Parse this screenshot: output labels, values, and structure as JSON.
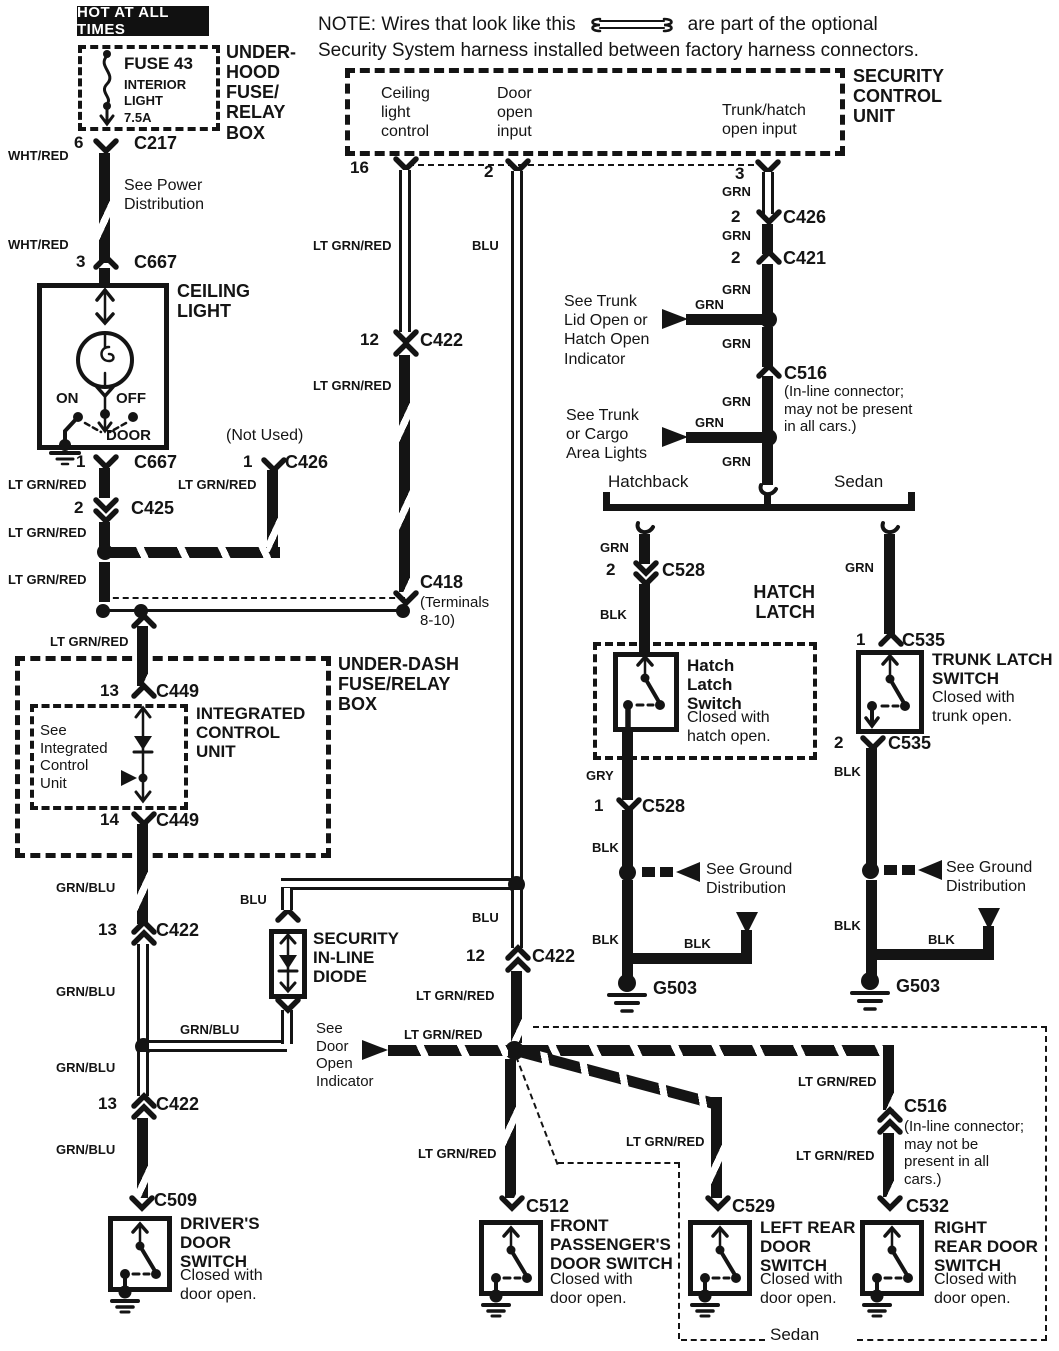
{
  "note": {
    "line1_pre": "NOTE: Wires that look like this",
    "line1_post": "are part of the optional",
    "line2": "Security System harness installed between factory harness connectors."
  },
  "wirelabels": {
    "wht_red": "WHT/RED",
    "lt_grn_red": "LT GRN/RED",
    "blu": "BLU",
    "grn": "GRN",
    "blk": "BLK",
    "gry": "GRY",
    "grn_blu": "GRN/BLU"
  },
  "underhood": {
    "hot": "HOT AT ALL TIMES",
    "fuse": "FUSE 43",
    "fuse_sub": "INTERIOR\nLIGHT\n7.5A",
    "box": "UNDER-\nHOOD\nFUSE/\nRELAY\nBOX",
    "pin6": "6",
    "c217": "C217",
    "see_power": "See Power\nDistribution",
    "pin3": "3",
    "c667": "C667"
  },
  "ceiling": {
    "title": "CEILING\nLIGHT",
    "on": "ON",
    "off": "OFF",
    "door": "DOOR",
    "pin1": "1",
    "c667": "C667",
    "pin2": "2",
    "c425": "C425",
    "not_used": "(Not Used)",
    "pin1_c426": "1",
    "c426": "C426"
  },
  "scu": {
    "title": "SECURITY\nCONTROL\nUNIT",
    "ceiling_ctl": "Ceiling\nlight\ncontrol",
    "door_input": "Door\nopen\ninput",
    "trunk_input": "Trunk/hatch\nopen input",
    "pin16": "16",
    "pin2": "2",
    "pin3": "3"
  },
  "run405": {
    "pin12": "12",
    "c422": "C422",
    "c418": "C418",
    "c418_sub": "(Terminals\n8-10)"
  },
  "trunkcol": {
    "pin2_c426": "2",
    "c426": "C426",
    "pin2_c421": "2",
    "c421": "C421",
    "see_trunk_lid": "See Trunk\nLid Open or\nHatch Open\nIndicator",
    "c516": "C516",
    "c516_sub": "(In-line connector;\nmay not be present\nin all cars.)",
    "see_cargo": "See Trunk\nor Cargo\nArea Lights",
    "hatchback": "Hatchback",
    "sedan": "Sedan"
  },
  "hatch": {
    "pin2": "2",
    "c528": "C528",
    "title": "HATCH\nLATCH",
    "name": "Hatch\nLatch\nSwitch",
    "desc": "Closed with\nhatch open.",
    "pin1": "1",
    "c528_lower": "C528",
    "see_ground": "See Ground\nDistribution",
    "g503": "G503"
  },
  "sedantrunk": {
    "pin1": "1",
    "c535": "C535",
    "name": "TRUNK LATCH\nSWITCH",
    "desc": "Closed with\ntrunk open.",
    "pin2": "2",
    "c535_lower": "C535",
    "see_ground": "See Ground\nDistribution",
    "g503": "G503"
  },
  "underdash": {
    "title": "UNDER-DASH\nFUSE/RELAY\nBOX",
    "pin13": "13",
    "c449": "C449",
    "icu_title": "INTEGRATED\nCONTROL\nUNIT",
    "icu_see": "See\nIntegrated\nControl\nUnit",
    "pin14": "14",
    "c449_lower": "C449"
  },
  "midcol": {
    "pin13_upper": "13",
    "c422_upper": "C422",
    "diode": "SECURITY\nIN-LINE\nDIODE",
    "pin13_lower": "13",
    "c422_lower": "C422",
    "c509": "C509"
  },
  "blucol": {
    "pin12": "12",
    "c422": "C422",
    "see_door": "See\nDoor\nOpen\nIndicator"
  },
  "doorswitches": {
    "driver_name": "DRIVER'S\nDOOR\nSWITCH",
    "closed": "Closed with\ndoor open.",
    "c512": "C512",
    "front_name": "FRONT\nPASSENGER'S\nDOOR SWITCH",
    "c529": "C529",
    "left_name": "LEFT REAR\nDOOR\nSWITCH",
    "c532": "C532",
    "right_name": "RIGHT\nREAR DOOR\nSWITCH",
    "c516": "C516",
    "c516_sub": "(In-line connector;\nmay not be\npresent in all\ncars.)",
    "sedan": "Sedan"
  }
}
